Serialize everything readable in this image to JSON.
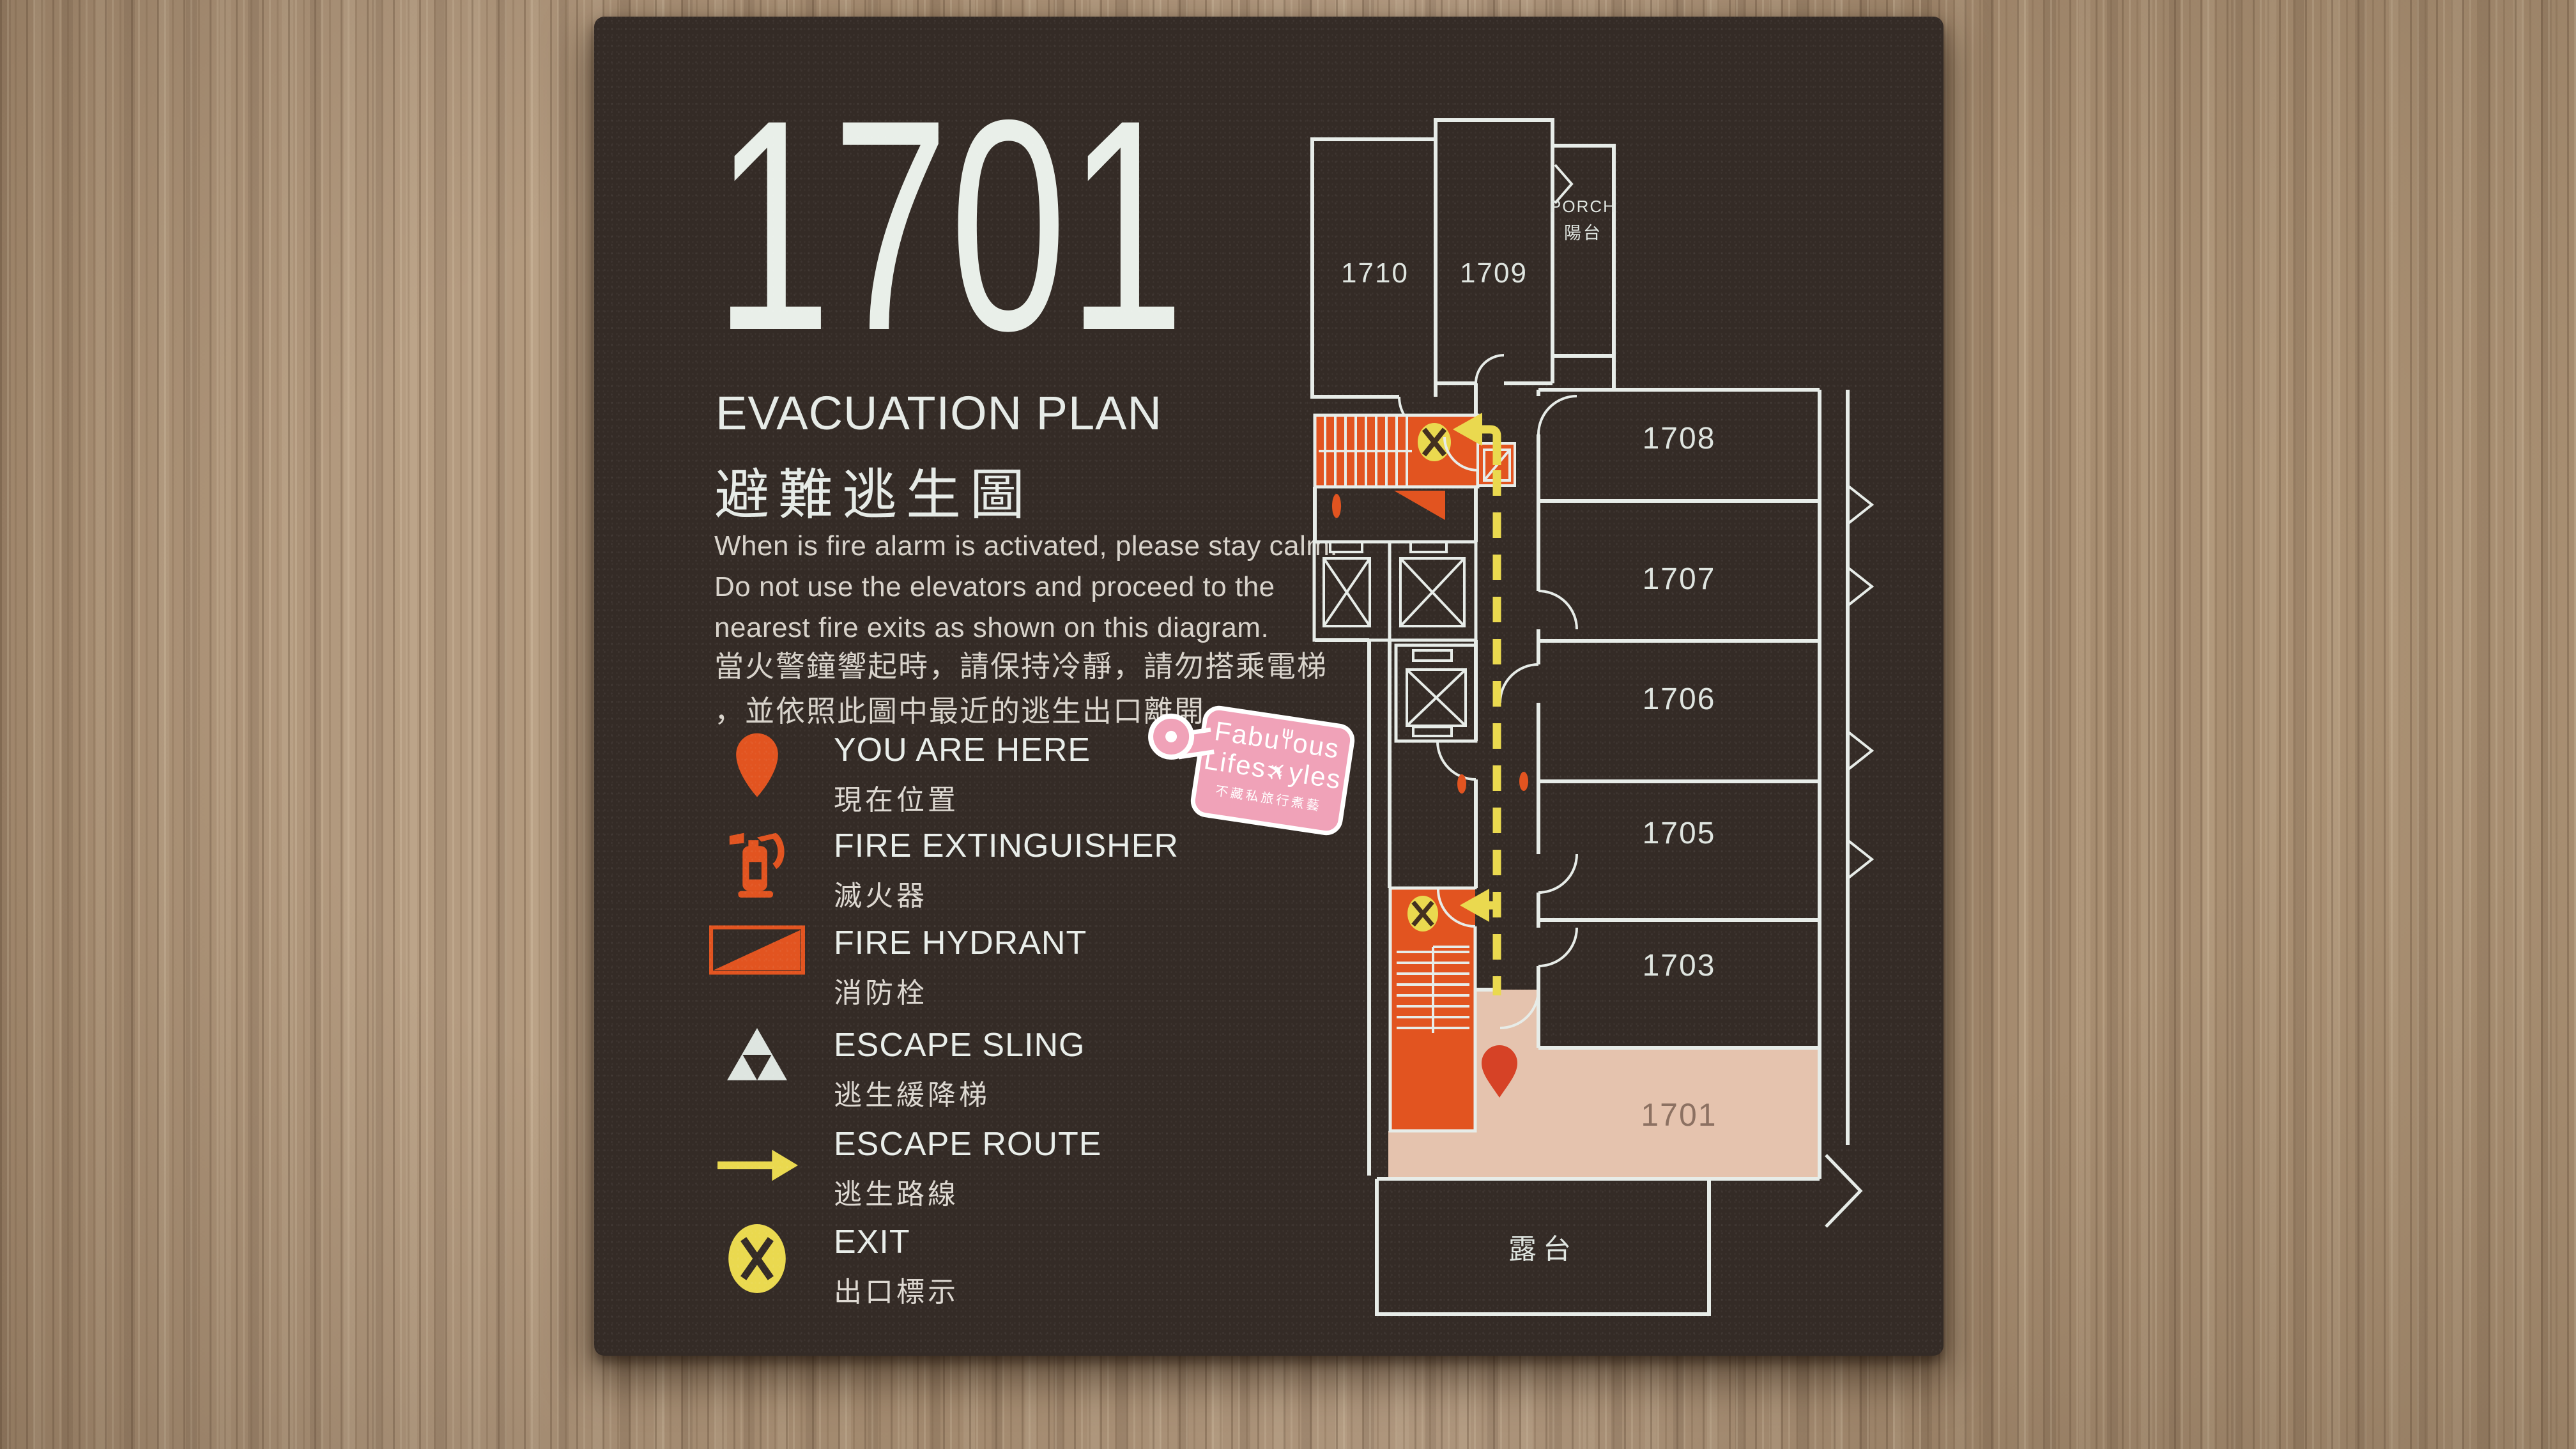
{
  "sign": {
    "room_number": "1701",
    "heading": {
      "en": "EVACUATION PLAN",
      "zh": "避難逃生圖"
    },
    "instructions": {
      "en_lines": [
        "When is fire alarm is activated, please stay calm.",
        "Do not use the elevators and proceed to the",
        "nearest fire exits as shown on this diagram."
      ],
      "zh_lines": [
        "當火警鐘響起時，請保持冷靜，請勿搭乘電梯",
        "，並依照此圖中最近的逃生出口離開。"
      ]
    },
    "legend": [
      {
        "icon": "you-are-here-pin-icon",
        "en": "YOU ARE HERE",
        "zh": "現在位置"
      },
      {
        "icon": "fire-extinguisher-icon",
        "en": "FIRE EXTINGUISHER",
        "zh": "滅火器"
      },
      {
        "icon": "fire-hydrant-icon",
        "en": "FIRE HYDRANT",
        "zh": "消防栓"
      },
      {
        "icon": "escape-sling-icon",
        "en": "ESCAPE SLING",
        "zh": "逃生緩降梯"
      },
      {
        "icon": "escape-route-icon",
        "en": "ESCAPE ROUTE",
        "zh": "逃生路線"
      },
      {
        "icon": "exit-icon",
        "en": "EXIT",
        "zh": "出口標示"
      }
    ],
    "floor_plan": {
      "labels": {
        "r1710": "1710",
        "r1709": "1709",
        "porch_en": "PORCH",
        "porch_zh": "陽台",
        "r1708": "1708",
        "r1707": "1707",
        "r1706": "1706",
        "r1705": "1705",
        "r1703": "1703",
        "r1701": "1701",
        "terrace_zh": "露台"
      },
      "highlighted_room": "1701"
    },
    "colors": {
      "panel": "#342b26",
      "line": "#e7ece8",
      "accent_orange": "#e25420",
      "accent_red": "#d64226",
      "accent_yellow": "#ead94f",
      "room_highlight": "#e5c3ae"
    }
  },
  "watermark": {
    "line1_pre": "Fabu",
    "line1_post": "ous",
    "line2_pre": "Lifes",
    "line2_post": "yles",
    "tagline": "不藏私旅行煮藝",
    "color": "#f0a2b8"
  }
}
